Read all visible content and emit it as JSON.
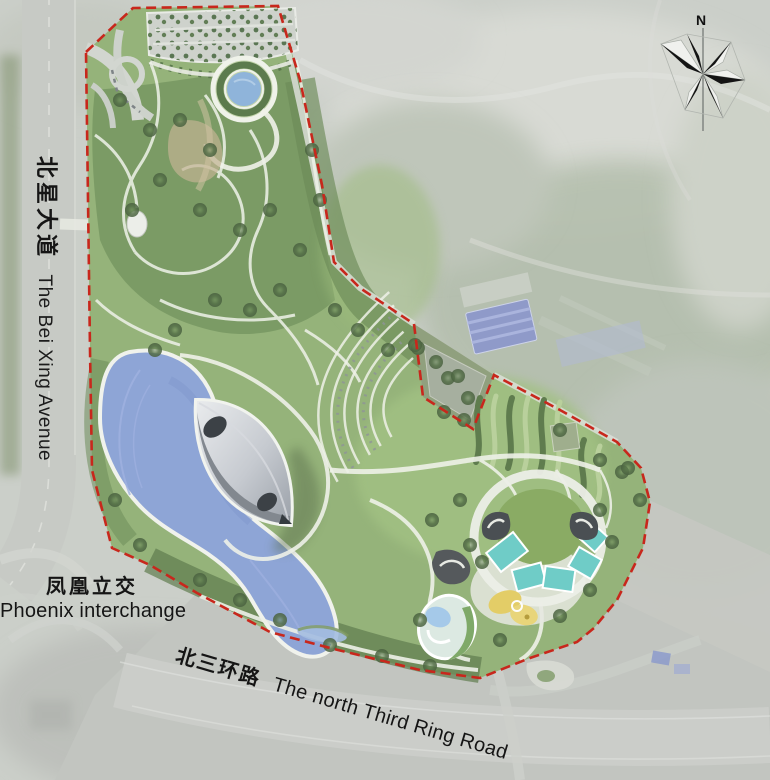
{
  "labels": {
    "bei_xing_avenue": {
      "zh": "北星大道",
      "en": "The Bei Xing Avenue"
    },
    "phoenix_interchange": {
      "zh": "凤凰立交",
      "en": "Phoenix interchange"
    },
    "third_ring_road": {
      "zh": "北三环路",
      "en": "The north Third Ring Road"
    }
  },
  "compass": {
    "north_label": "N"
  },
  "icons": {
    "compass": "compass-rose-icon"
  },
  "colors": {
    "boundary_red": "#c8271c",
    "lake_blue": "#8ea5d6",
    "park_green": "#95b37a",
    "pool_teal": "#6fccc7",
    "playground_yellow": "#e3cd67",
    "building_gray": "#b7bcc2"
  }
}
